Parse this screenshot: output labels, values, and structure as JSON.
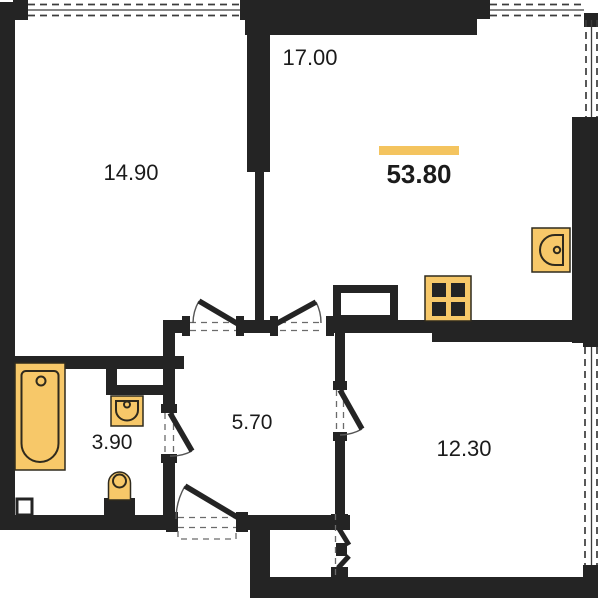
{
  "title": "apartment-floor-plan",
  "total": {
    "area": "53.80"
  },
  "rooms": [
    {
      "id": "room-top-left",
      "area": "14.90"
    },
    {
      "id": "room-top-right",
      "area": "17.00"
    },
    {
      "id": "bathroom",
      "area": "3.90"
    },
    {
      "id": "hallway",
      "area": "5.70"
    },
    {
      "id": "room-bottom-right",
      "area": "12.30"
    }
  ],
  "fixtures": [
    "bathtub-icon",
    "washbasin-icon",
    "toilet-icon",
    "kitchen-sink-icon",
    "stove-icon"
  ],
  "theme": {
    "wall_color": "#242424",
    "bg_color": "#ffffff",
    "fixture_fill": "#F7C869",
    "fixture_stroke": "#2f2a1d",
    "accent_color": "#F4C45F",
    "text_color": "#1b1b1b",
    "window_line": "#3c3c3c",
    "arc_color": "#555555"
  }
}
